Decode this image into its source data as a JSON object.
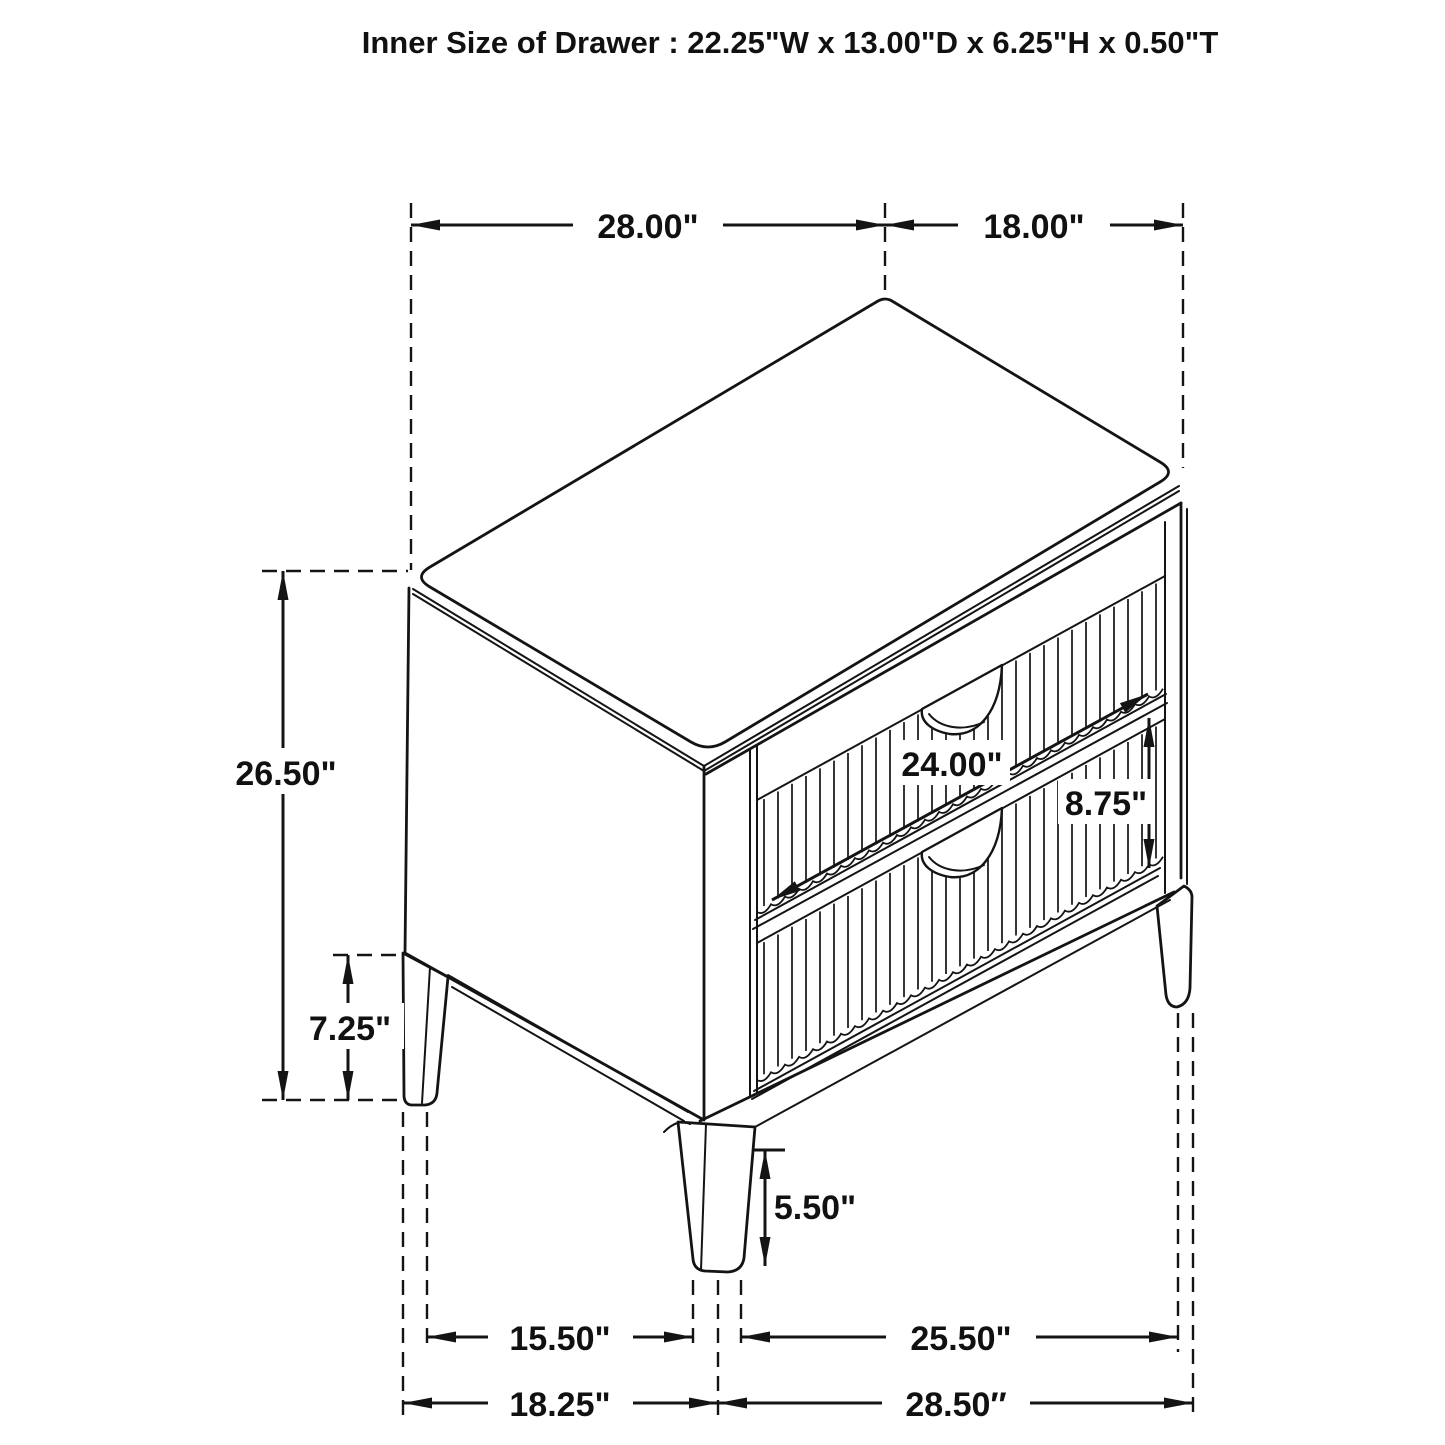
{
  "title": "Inner Size of Drawer : 22.25\"W x 13.00\"D x 6.25\"H x 0.50\"T",
  "diagram": "nightstand-2-drawer-dimension-drawing",
  "colors": {
    "line": "#141414",
    "background": "#ffffff"
  },
  "dimensions": {
    "top_left": {
      "label": "28.00\"",
      "meaning": "top panel span, left edge"
    },
    "top_right": {
      "label": "18.00\"",
      "meaning": "top panel span, right edge"
    },
    "overall_height": {
      "label": "26.50\"",
      "meaning": "overall height"
    },
    "base_height": {
      "label": "7.25\"",
      "meaning": "floor to case bottom"
    },
    "drawer_width": {
      "label": "24.00\"",
      "meaning": "drawer face width"
    },
    "drawer_height": {
      "label": "8.75\"",
      "meaning": "drawer face height"
    },
    "leg_height": {
      "label": "5.50\"",
      "meaning": "front leg height"
    },
    "bottom_left_inner": {
      "label": "15.50\"",
      "meaning": "between legs, left side"
    },
    "bottom_right_inner": {
      "label": "25.50\"",
      "meaning": "between legs, right side"
    },
    "bottom_left_outer": {
      "label": "18.25\"",
      "meaning": "outer leg span, left side"
    },
    "bottom_right_outer": {
      "label": "28.50″",
      "meaning": "outer leg span, right side"
    }
  }
}
